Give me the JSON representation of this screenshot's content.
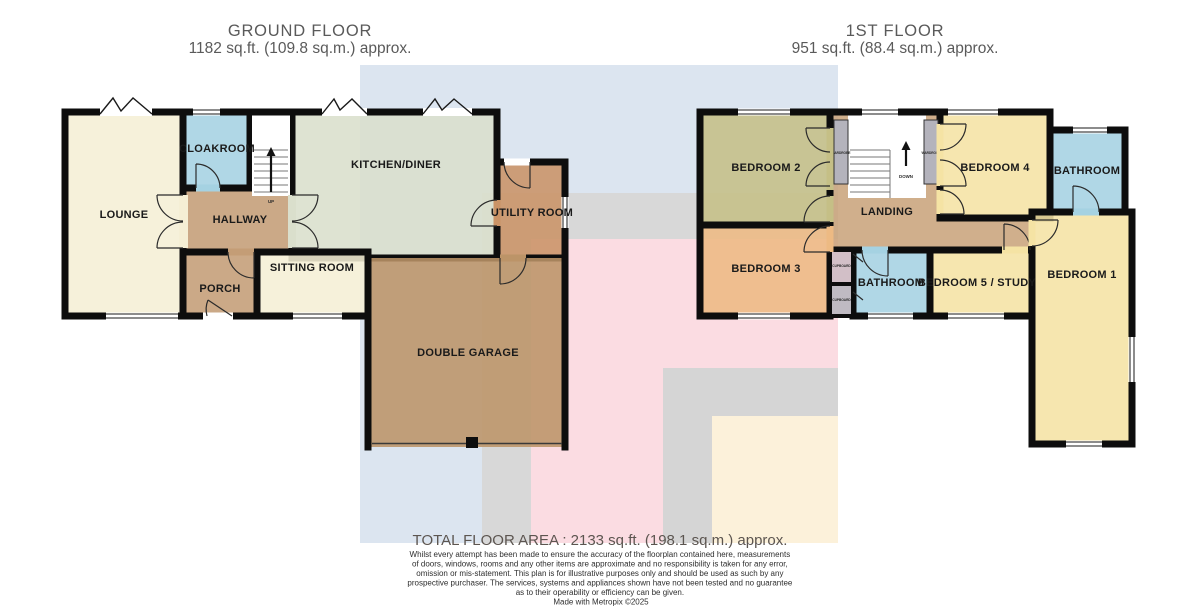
{
  "ground_floor": {
    "title": "GROUND FLOOR",
    "area": "1182 sq.ft. (109.8 sq.m.) approx.",
    "rooms": {
      "lounge": {
        "label": "LOUNGE"
      },
      "cloakroom": {
        "label": "CLOAKROOM"
      },
      "hallway": {
        "label": "HALLWAY"
      },
      "porch": {
        "label": "PORCH"
      },
      "sitting_room": {
        "label": "SITTING ROOM"
      },
      "kitchen_diner": {
        "label": "KITCHEN/DINER"
      },
      "utility_room": {
        "label": "UTILITY ROOM"
      },
      "double_garage": {
        "label": "DOUBLE GARAGE"
      }
    },
    "stairs": {
      "label": "UP"
    }
  },
  "first_floor": {
    "title": "1ST FLOOR",
    "area": "951 sq.ft. (88.4 sq.m.) approx.",
    "rooms": {
      "bedroom2": {
        "label": "BEDROOM 2"
      },
      "bedroom3": {
        "label": "BEDROOM 3"
      },
      "landing": {
        "label": "LANDING"
      },
      "bedroom4": {
        "label": "BEDROOM 4"
      },
      "bathroom_top": {
        "label": "BATHROOM"
      },
      "bedroom1": {
        "label": "BEDROOM 1"
      },
      "bathroom": {
        "label": "BATHROOM"
      },
      "bedroom5_study": {
        "label": "BEDROOM 5 / STUDY"
      }
    },
    "stairs": {
      "label": "DOWN"
    },
    "wardrobe_left": {
      "label": "WARDROBE"
    },
    "wardrobe_right": {
      "label": "WARDROBE"
    },
    "cupboard_upper": {
      "label": "CUPBOARD"
    },
    "cupboard_lower": {
      "label": "CUPBOARD"
    }
  },
  "footer": {
    "total_area": "TOTAL FLOOR AREA : 2133 sq.ft. (198.1 sq.m.) approx.",
    "disclaimer_lines": [
      "Whilst every attempt has been made to ensure the accuracy of the floorplan contained here, measurements",
      "of doors, windows, rooms and any other items are approximate and no responsibility is taken for any error,",
      "omission or mis-statement. This plan is for illustrative purposes only and should be used as such by any",
      "prospective purchaser. The services, systems and appliances shown have not been tested and no guarantee",
      "as to their operability or efficiency can be given."
    ],
    "credit": "Made with Metropix ©2025"
  },
  "palette": {
    "wall": "#0d0d0d",
    "cream": "#f5efd5",
    "blue_room": "#a5d2e2",
    "hall_tan": "#c49d76",
    "landing_tan": "#c9a47c",
    "kitchen_sage": "#dadfcc",
    "utility": "#ca9366",
    "garage": "#bc9468",
    "bedroom2_olive": "#c5bf86",
    "bedroom3_peach": "#edba83",
    "bedroom_yellow": "#f5e3a4",
    "wardrobe_gray": "#b4b3bc",
    "cupboard_upper": "#d2bfc7",
    "cupboard_lower": "#bfbac2",
    "watermark_blue": "#dce5f0",
    "watermark_gray": "#d8d8d8",
    "watermark_pink": "#fbdce2",
    "watermark_cream": "#fcf1da"
  }
}
